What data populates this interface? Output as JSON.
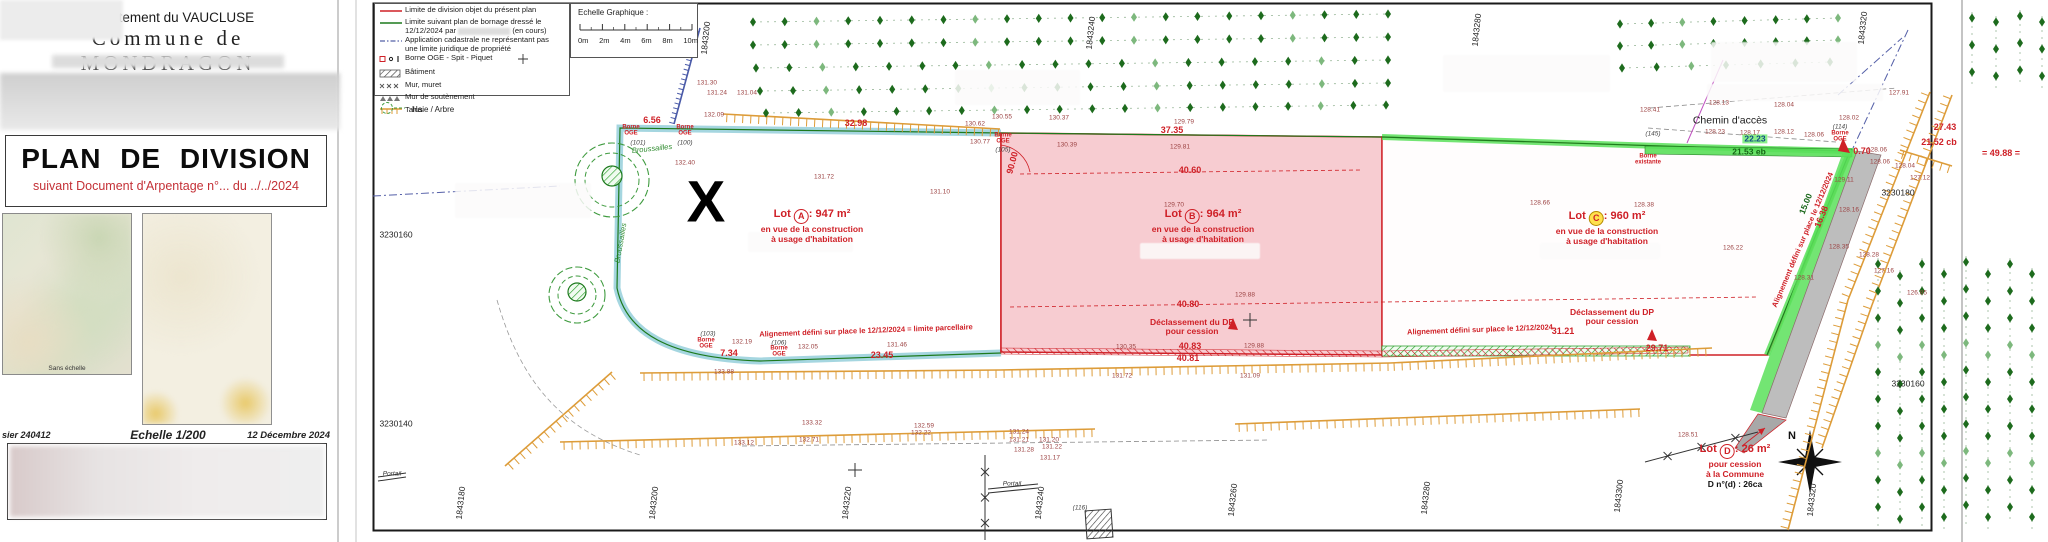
{
  "left_panel": {
    "department": "Département du VAUCLUSE",
    "commune": "Commune de MONDRAGON",
    "title": "PLAN  DE  DIVISION",
    "subtitle": "suivant Document d'Arpentage n°... du ../../2024",
    "map_caption": "Sans échelle",
    "footer": {
      "dossier": "sier 240412",
      "scale": "Echelle 1/200",
      "date": "12 Décembre 2024"
    }
  },
  "legend": {
    "items": [
      {
        "label": "Limite de division objet du présent plan"
      },
      {
        "label": "Limite suivant plan de bornage dressé le",
        "label2_pre": "12/12/2024 par",
        "label2_post": "(en cours)"
      },
      {
        "label": "Application cadastrale ne représentant pas",
        "label2": "une limite juridique de propriété"
      },
      {
        "label": "Borne OGE - Spit - Piquet"
      },
      {
        "label": "Bâtiment"
      },
      {
        "label": "Mur, muret"
      },
      {
        "label": "Mur de soutènement"
      },
      {
        "label": "Talus"
      }
    ],
    "haie": "Haie / Arbre"
  },
  "scalebar": {
    "title": "Echelle Graphique :",
    "ticks": [
      "0m",
      "2m",
      "4m",
      "6m",
      "8m",
      "10m"
    ]
  },
  "lots": [
    {
      "name": "Lot",
      "letter": "A",
      "area": ": 947 m²",
      "lines": [
        "en vue de la construction",
        "à usage d'habitation"
      ],
      "x": 812,
      "y": 208
    },
    {
      "name": "Lot",
      "letter": "B",
      "area": ": 964 m²",
      "lines": [
        "en vue de la construction",
        "à usage d'habitation"
      ],
      "x": 1203,
      "y": 208
    },
    {
      "name": "Lot",
      "letter": "C",
      "area": ": 960 m²",
      "lines": [
        "en vue de la construction",
        "à usage d'habitation"
      ],
      "x": 1607,
      "y": 210,
      "yellow": true
    },
    {
      "name": "Lot",
      "letter": "D",
      "area": ": 26 m²",
      "lines": [
        "pour cession",
        "à la Commune"
      ],
      "extra": "D n°(d) : 26ca",
      "x": 1735,
      "y": 443
    }
  ],
  "plan": {
    "labels": [
      [
        "X",
        706,
        203,
        "bigx"
      ],
      [
        "N",
        1792,
        437,
        "kb"
      ],
      [
        "6.56",
        652,
        121,
        "m"
      ],
      [
        "32.98",
        856,
        124,
        "m"
      ],
      [
        "37.35",
        1172,
        131,
        "m"
      ],
      [
        "40.60",
        1190,
        171,
        "m"
      ],
      [
        "40.80",
        1188,
        305,
        "m"
      ],
      [
        "40.83",
        1190,
        347,
        "m"
      ],
      [
        "40.81",
        1188,
        359,
        "m"
      ],
      [
        "23.45",
        882,
        356,
        "m"
      ],
      [
        "7.34",
        729,
        354,
        "m"
      ],
      [
        "31.21",
        1563,
        332,
        "m"
      ],
      [
        "29.71",
        1657,
        349,
        "m"
      ],
      [
        "0.70",
        1862,
        152,
        "m"
      ],
      [
        "27.43",
        1945,
        128,
        "m"
      ],
      [
        "21.52 cb",
        1939,
        143,
        "m"
      ],
      [
        "= 49.88 =",
        2001,
        154,
        "m"
      ],
      [
        "90.00",
        1013,
        163,
        "m",
        -75
      ],
      [
        "16.38",
        1822,
        217,
        "m",
        -68
      ],
      [
        "15.00",
        1806,
        204,
        "g",
        -68
      ],
      [
        "21.53 eb",
        1749,
        152,
        "g"
      ],
      [
        "22.23",
        1755,
        139,
        "gb"
      ],
      [
        "132.40",
        685,
        163,
        "e"
      ],
      [
        "131.72",
        824,
        177,
        "e"
      ],
      [
        "131.10",
        940,
        192,
        "e"
      ],
      [
        "129.70",
        1174,
        205,
        "e"
      ],
      [
        "128.66",
        1540,
        203,
        "e"
      ],
      [
        "128.38",
        1644,
        205,
        "e"
      ],
      [
        "126.22",
        1733,
        248,
        "e"
      ],
      [
        "130.55",
        1002,
        117,
        "e"
      ],
      [
        "130.37",
        1059,
        118,
        "e"
      ],
      [
        "130.62",
        975,
        124,
        "e"
      ],
      [
        "130.77",
        980,
        142,
        "e"
      ],
      [
        "130.39",
        1067,
        145,
        "e"
      ],
      [
        "129.79",
        1184,
        122,
        "e"
      ],
      [
        "129.81",
        1180,
        147,
        "e"
      ],
      [
        "131.30",
        707,
        83,
        "e"
      ],
      [
        "131.24",
        717,
        93,
        "e"
      ],
      [
        "131.04",
        747,
        93,
        "e"
      ],
      [
        "132.09",
        714,
        115,
        "e"
      ],
      [
        "132.19",
        742,
        342,
        "e"
      ],
      [
        "132.05",
        808,
        347,
        "e"
      ],
      [
        "131.46",
        897,
        345,
        "e"
      ],
      [
        "133.88",
        724,
        372,
        "e"
      ],
      [
        "130.35",
        1126,
        347,
        "e"
      ],
      [
        "129.88",
        1245,
        295,
        "e"
      ],
      [
        "129.88",
        1254,
        346,
        "e"
      ],
      [
        "131.09",
        1250,
        376,
        "e"
      ],
      [
        "131.72",
        1122,
        376,
        "e"
      ],
      [
        "133.32",
        812,
        423,
        "e"
      ],
      [
        "132.59",
        924,
        426,
        "e"
      ],
      [
        "132.22",
        921,
        433,
        "e"
      ],
      [
        "132.71",
        809,
        440,
        "e"
      ],
      [
        "133.12",
        744,
        443,
        "e"
      ],
      [
        "131.24",
        1019,
        432,
        "e"
      ],
      [
        "131.21",
        1019,
        440,
        "e"
      ],
      [
        "131.20",
        1049,
        440,
        "e"
      ],
      [
        "131.22",
        1052,
        447,
        "e"
      ],
      [
        "131.28",
        1024,
        450,
        "e"
      ],
      [
        "131.17",
        1050,
        458,
        "e"
      ],
      [
        "128.13",
        1719,
        103,
        "e"
      ],
      [
        "128.04",
        1784,
        105,
        "e"
      ],
      [
        "128.41",
        1650,
        110,
        "e"
      ],
      [
        "128.23",
        1715,
        132,
        "e"
      ],
      [
        "128.17",
        1750,
        133,
        "e"
      ],
      [
        "128.12",
        1784,
        132,
        "e"
      ],
      [
        "128.06",
        1814,
        135,
        "e"
      ],
      [
        "128.02",
        1849,
        118,
        "e"
      ],
      [
        "127.91",
        1899,
        93,
        "e"
      ],
      [
        "128.06",
        1877,
        150,
        "e"
      ],
      [
        "128.06",
        1880,
        162,
        "e"
      ],
      [
        "128.04",
        1905,
        166,
        "e"
      ],
      [
        "127.12",
        1920,
        178,
        "e"
      ],
      [
        "129.11",
        1844,
        180,
        "e"
      ],
      [
        "128.16",
        1849,
        210,
        "e"
      ],
      [
        "128.35",
        1839,
        247,
        "e"
      ],
      [
        "128.28",
        1869,
        255,
        "e"
      ],
      [
        "127.16",
        1884,
        271,
        "e"
      ],
      [
        "126.85",
        1917,
        293,
        "e"
      ],
      [
        "128.31",
        1804,
        278,
        "e"
      ],
      [
        "128.51",
        1688,
        435,
        "e"
      ],
      [
        "Borne|OGE",
        631,
        131,
        "b"
      ],
      [
        "Borne|OGE",
        685,
        131,
        "b"
      ],
      [
        "Borne|OGE",
        1003,
        139,
        "b"
      ],
      [
        "Borne|OGE",
        706,
        344,
        "b"
      ],
      [
        "Borne|OGE",
        779,
        352,
        "b"
      ],
      [
        "Borne|OGE",
        1840,
        137,
        "b"
      ],
      [
        "Borne|existante",
        1648,
        160,
        "b"
      ],
      [
        "(101)",
        638,
        143,
        "pt"
      ],
      [
        "(100)",
        685,
        143,
        "pt"
      ],
      [
        "(105)",
        1003,
        150,
        "pt"
      ],
      [
        "(103)",
        708,
        334,
        "pt"
      ],
      [
        "(106)",
        779,
        343,
        "pt"
      ],
      [
        "(114)",
        1840,
        127,
        "pt"
      ],
      [
        "(145)",
        1653,
        134,
        "pt"
      ],
      [
        "(116)",
        1080,
        508,
        "pt"
      ],
      [
        "Chemin d'accès",
        1730,
        121,
        "k"
      ],
      [
        "Portail",
        1012,
        484,
        "ki"
      ],
      [
        "Portail",
        392,
        474,
        "ki"
      ],
      [
        "Broussailles",
        652,
        149,
        "gn",
        -6
      ],
      [
        "Broussailles",
        621,
        243,
        "gn",
        -80
      ],
      [
        "Alignement défini sur place le 12/12/2024 = limite parcellaire",
        866,
        331,
        "rl",
        -2
      ],
      [
        "Alignement défini sur place le 12/12/2024",
        1480,
        330,
        "rl",
        -2
      ],
      [
        "Alignement défini sur place le 12/12/2024",
        1803,
        240,
        "rl",
        -67
      ],
      [
        "Déclassement du DP|pour cession",
        1192,
        327,
        "rl2"
      ],
      [
        "Déclassement du DP|pour cession",
        1612,
        317,
        "rl2"
      ],
      [
        "3230160",
        396,
        235,
        "coord"
      ],
      [
        "3230140",
        396,
        424,
        "coord"
      ],
      [
        "3230180",
        1898,
        193,
        "coord"
      ],
      [
        "3230160",
        1908,
        384,
        "coord"
      ],
      [
        "1843200",
        706,
        38,
        "coord",
        -84
      ],
      [
        "1843240",
        1091,
        33,
        "coord",
        -84
      ],
      [
        "1843280",
        1477,
        30,
        "coord",
        -84
      ],
      [
        "1843320",
        1863,
        28,
        "coord",
        -84
      ],
      [
        "1843180",
        461,
        503,
        "coord",
        -84
      ],
      [
        "1843200",
        654,
        503,
        "coord",
        -84
      ],
      [
        "1843220",
        847,
        503,
        "coord",
        -84
      ],
      [
        "1843240",
        1040,
        503,
        "coord",
        -84
      ],
      [
        "1843260",
        1233,
        500,
        "coord",
        -84
      ],
      [
        "1843280",
        1426,
        498,
        "coord",
        -84
      ],
      [
        "1843300",
        1619,
        496,
        "coord",
        -84
      ],
      [
        "1843320",
        1812,
        500,
        "coord",
        -84
      ]
    ],
    "hedge_rows": [
      {
        "x1": 753,
        "y1": 22,
        "x2": 1388,
        "y2": 14,
        "n": 21
      },
      {
        "x1": 753,
        "y1": 45,
        "x2": 1388,
        "y2": 37,
        "n": 21
      },
      {
        "x1": 756,
        "y1": 68,
        "x2": 1388,
        "y2": 60,
        "n": 20
      },
      {
        "x1": 760,
        "y1": 91,
        "x2": 1388,
        "y2": 83,
        "n": 20
      },
      {
        "x1": 766,
        "y1": 113,
        "x2": 1386,
        "y2": 105,
        "n": 20
      },
      {
        "x1": 1620,
        "y1": 24,
        "x2": 1838,
        "y2": 18,
        "n": 8
      },
      {
        "x1": 1620,
        "y1": 46,
        "x2": 1838,
        "y2": 40,
        "n": 8
      },
      {
        "x1": 1622,
        "y1": 68,
        "x2": 1830,
        "y2": 62,
        "n": 7
      }
    ],
    "vine_columns": [
      {
        "x": 1878,
        "y1": 258,
        "y2": 528
      },
      {
        "x": 1900,
        "y1": 270,
        "y2": 530
      },
      {
        "x": 1922,
        "y1": 258,
        "y2": 528
      },
      {
        "x": 1944,
        "y1": 268,
        "y2": 530
      },
      {
        "x": 1966,
        "y1": 256,
        "y2": 526
      },
      {
        "x": 1988,
        "y1": 268,
        "y2": 530
      },
      {
        "x": 2010,
        "y1": 258,
        "y2": 524
      },
      {
        "x": 2032,
        "y1": 268,
        "y2": 530
      },
      {
        "x": 1972,
        "y1": 12,
        "y2": 88
      },
      {
        "x": 1996,
        "y1": 16,
        "y2": 92
      },
      {
        "x": 2020,
        "y1": 10,
        "y2": 86
      },
      {
        "x": 2042,
        "y1": 16,
        "y2": 90
      }
    ],
    "talus": [
      {
        "pts": [
          [
            640,
            373
          ],
          [
            1000,
            370
          ],
          [
            1390,
            363
          ],
          [
            1712,
            348
          ]
        ]
      },
      {
        "pts": [
          [
            560,
            442
          ],
          [
            1095,
            429
          ]
        ]
      },
      {
        "pts": [
          [
            1235,
            424
          ],
          [
            1640,
            409
          ]
        ]
      },
      {
        "pts": [
          [
            1930,
            92
          ],
          [
            1848,
            300
          ],
          [
            1788,
            530
          ]
        ]
      },
      {
        "pts": [
          [
            1952,
            95
          ],
          [
            1872,
            305
          ],
          [
            1822,
            448
          ]
        ]
      },
      {
        "pts": [
          [
            723,
            114
          ],
          [
            1000,
            129
          ]
        ]
      },
      {
        "pts": [
          [
            505,
            466
          ],
          [
            612,
            372
          ]
        ]
      },
      {
        "pts": [
          [
            1900,
            150
          ],
          [
            1952,
            166
          ]
        ]
      },
      {
        "pts": [
          [
            700,
            28
          ],
          [
            674,
            124
          ]
        ],
        "c": "#4a5aa8",
        "l": 5,
        "g": 5
      }
    ],
    "fences": [
      {
        "pts": [
          [
            1645,
            462
          ],
          [
            1758,
            432
          ]
        ]
      },
      {
        "pts": [
          [
            985,
            455
          ],
          [
            985,
            540
          ]
        ]
      }
    ],
    "crosses": [
      [
        1250,
        320
      ],
      [
        855,
        470
      ]
    ],
    "blurs": [
      [
        455,
        183,
        136,
        35
      ],
      [
        955,
        70,
        125,
        35
      ],
      [
        1443,
        55,
        167,
        37
      ],
      [
        1711,
        42,
        146,
        40
      ],
      [
        1707,
        84,
        176,
        17
      ],
      [
        1140,
        243,
        120,
        16
      ],
      [
        1540,
        243,
        120,
        16
      ],
      [
        748,
        232,
        105,
        20
      ]
    ]
  },
  "colors": {
    "accent_red": "#cf2027",
    "bornage_green": "#1d7a1d",
    "highlight_green": "#5ae05a",
    "teal": "#8fccd8",
    "pink": "#f7ccd1",
    "talus_orange": "#dd9c39"
  }
}
